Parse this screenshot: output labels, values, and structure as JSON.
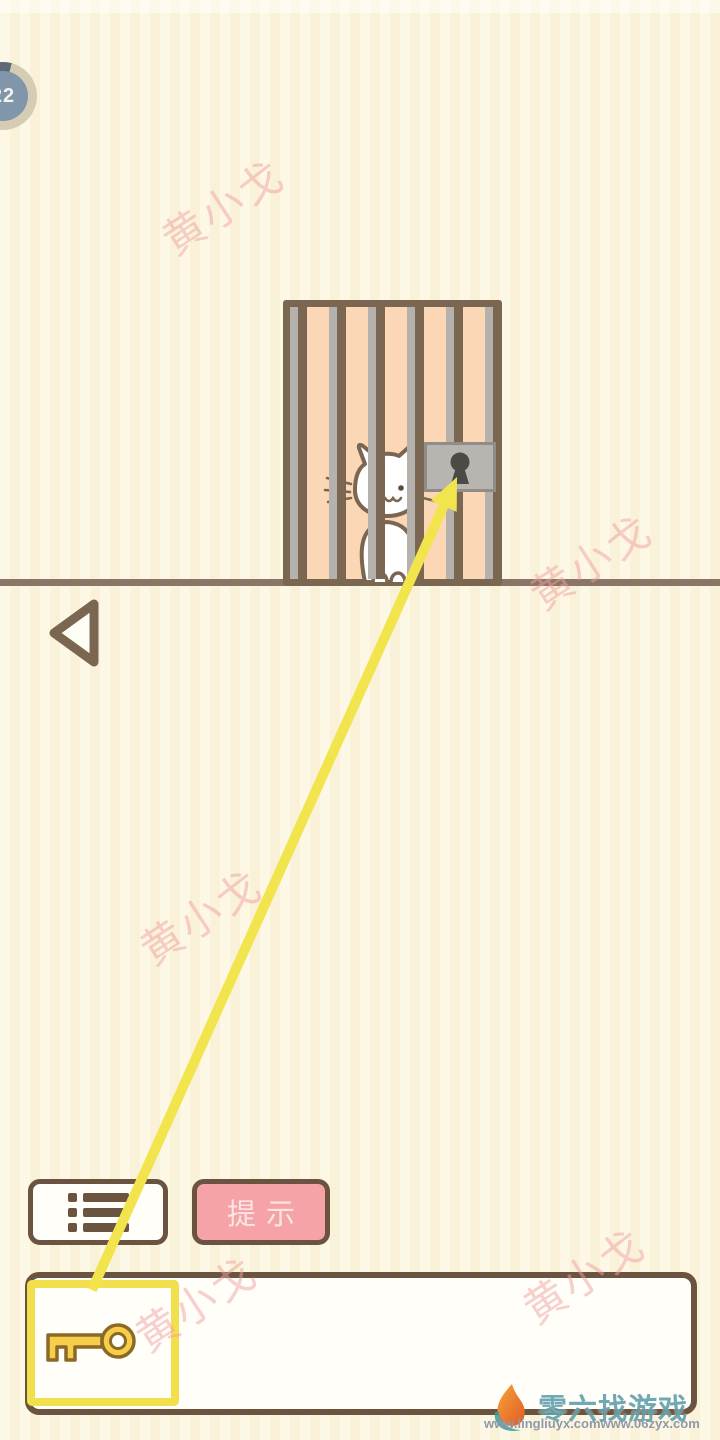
{
  "level_badge": {
    "value": "22"
  },
  "watermark": {
    "text": "黄小戈"
  },
  "buttons": {
    "hint_label": "提示",
    "menu_icon": "list-icon",
    "back_icon": "back-triangle-icon"
  },
  "scene": {
    "cage_icon": "cage-with-bars",
    "cat_icon": "white-cat",
    "lock_icon": "padlock-keyhole",
    "hint_arrow_icon": "yellow-arrow-key-to-lock"
  },
  "inventory": {
    "items": [
      {
        "icon": "key-icon",
        "selected": true
      }
    ]
  },
  "footer": {
    "logo_icon": "flame-6-logo",
    "site_name": "零六找游戏",
    "url_left": "www.lingliuyx.com",
    "url_right": "www.06zyx.com"
  },
  "colors": {
    "background_stripe_light": "#fdf8e6",
    "background_stripe_dark": "#f9f2d9",
    "brown_outline": "#6b543f",
    "cage_frame": "#7b6651",
    "cage_fill": "#fbd7b5",
    "bar_gray": "#b5b1ad",
    "lock_gray": "#b8b5b1",
    "hint_pink": "#f5a3a6",
    "accent_yellow": "#f2e04d",
    "watermark_pink": "#f0a0a0",
    "footer_teal": "#3d8fa0",
    "footer_url_gray": "#8f99a8"
  }
}
